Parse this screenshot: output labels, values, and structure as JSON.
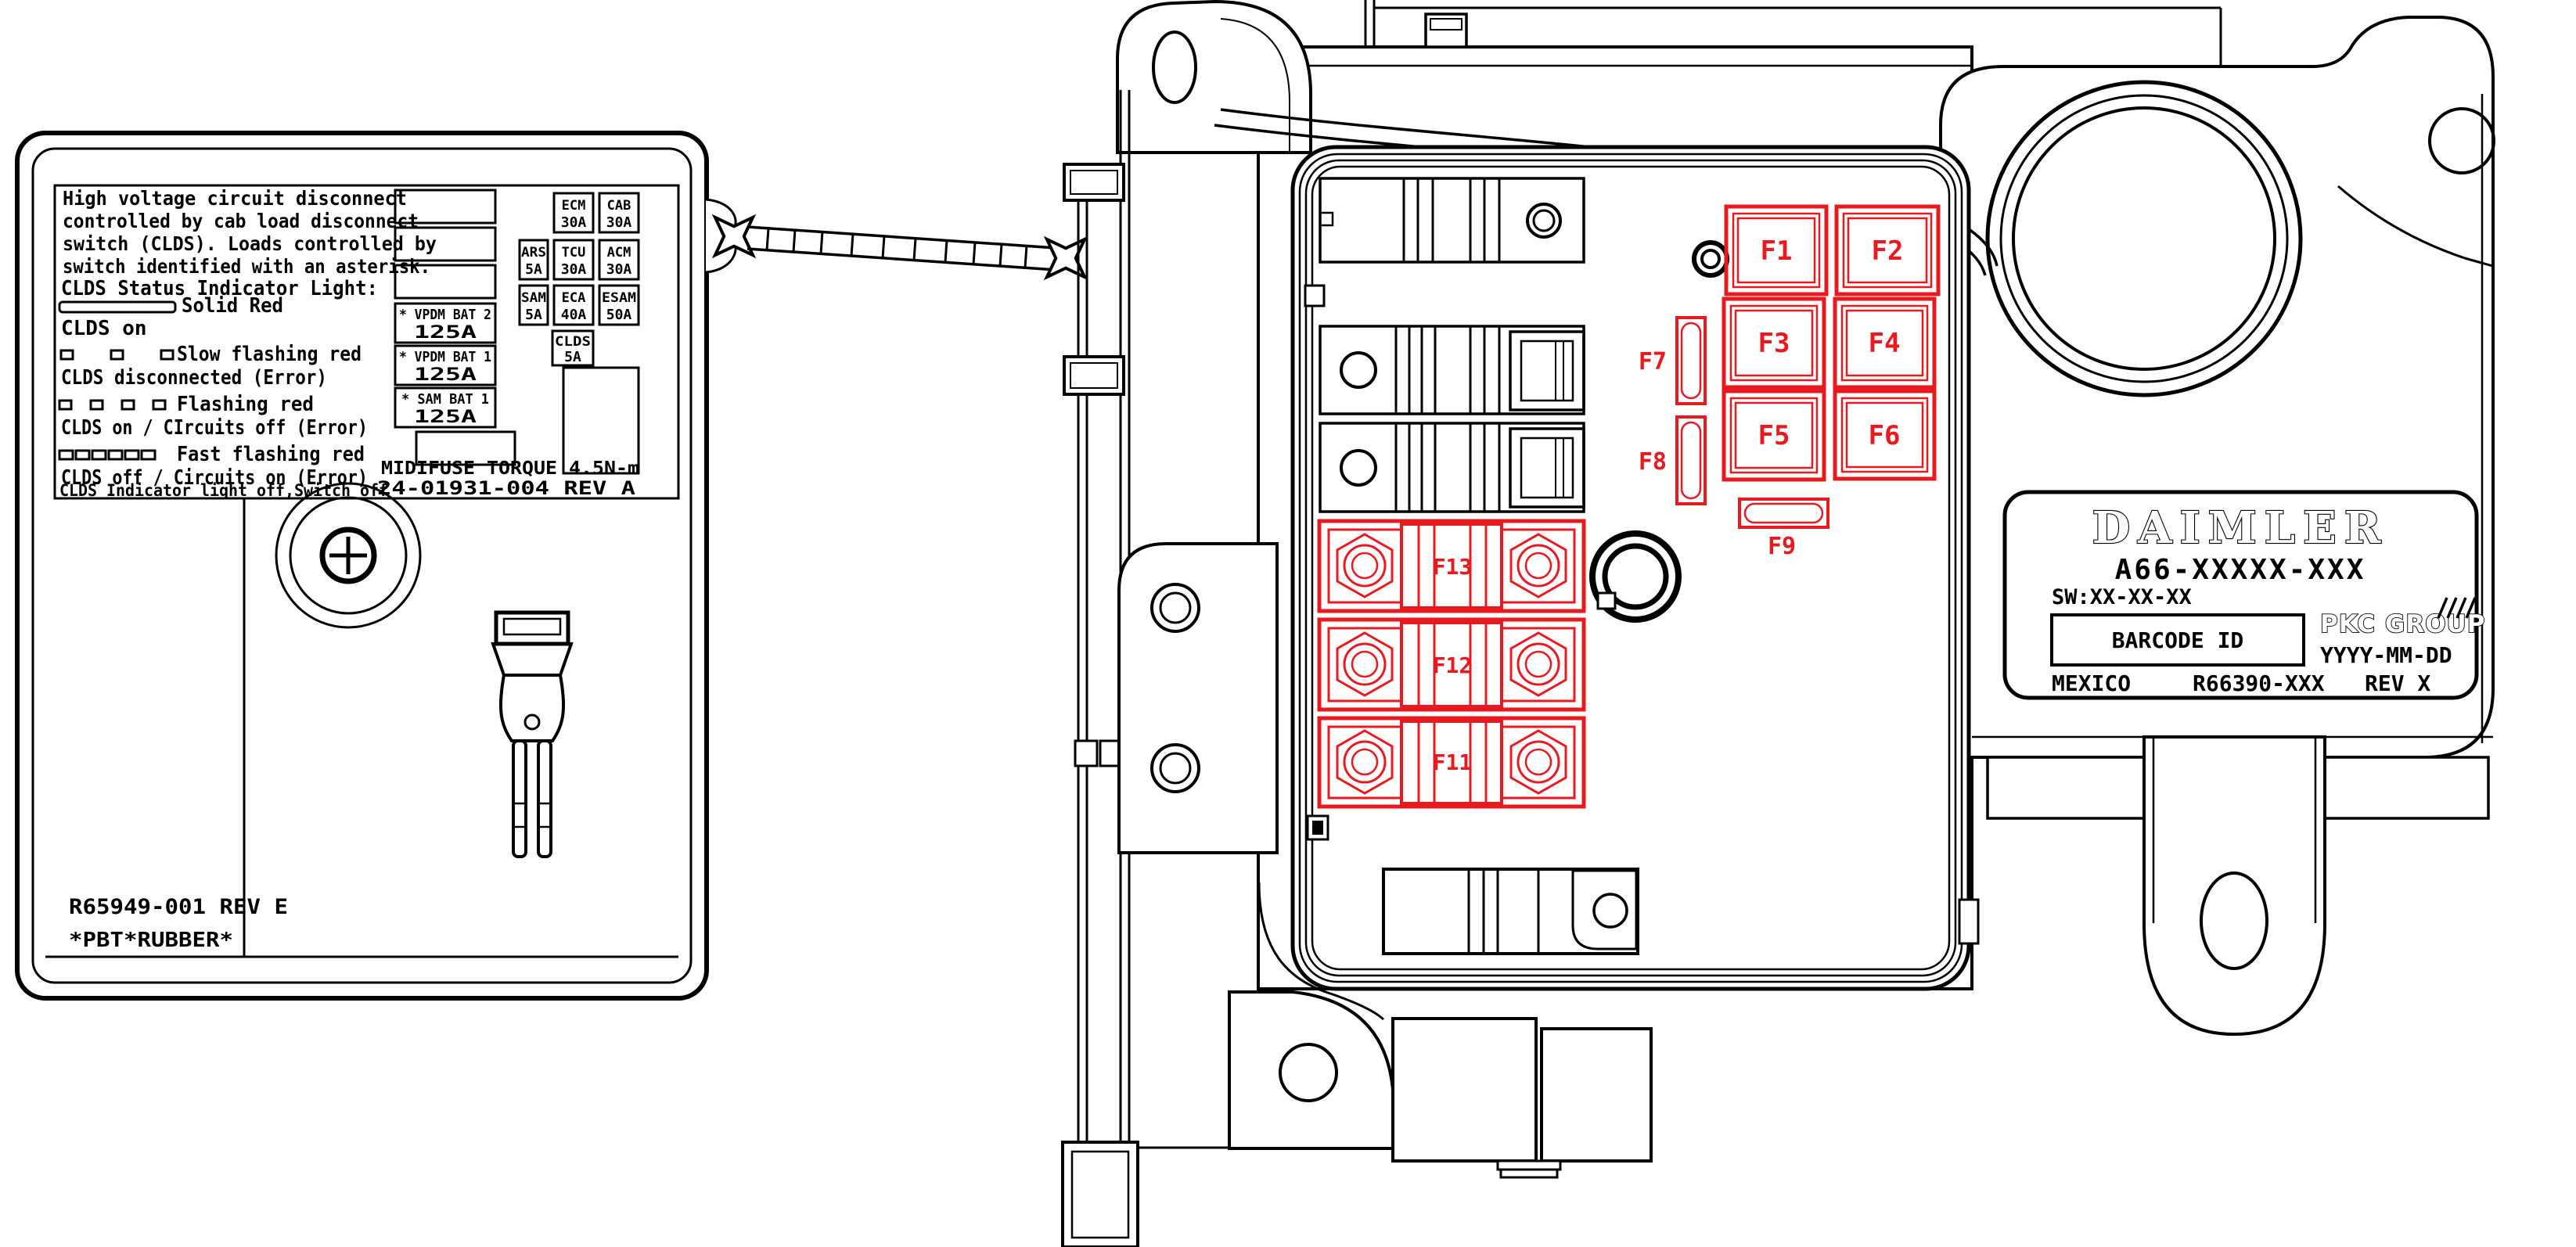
{
  "warning_label": {
    "description_lines": [
      "High voltage circuit disconnect",
      "controlled by cab load disconnect",
      "switch (CLDS).  Loads controlled by",
      "switch identified with an asterisk."
    ],
    "status_title": "CLDS Status Indicator Light:",
    "states": [
      {
        "pattern": "solid",
        "label": "Solid Red",
        "meaning": "CLDS on"
      },
      {
        "pattern": "slow-flash",
        "label": "Slow flashing red",
        "meaning": "CLDS disconnected (Error)"
      },
      {
        "pattern": "flash",
        "label": "Flashing red",
        "meaning": "CLDS on / CIrcuits off (Error)"
      },
      {
        "pattern": "fast-flash",
        "label": "Fast flashing red",
        "meaning": "CLDS off / Circuits on (Error)"
      }
    ],
    "off_note": "CLDS Indicator light off,Switch off",
    "midi_fuses": [
      {
        "name": "* VPDM BAT 2",
        "rating": "125A"
      },
      {
        "name": "* VPDM BAT 1",
        "rating": "125A"
      },
      {
        "name": "* SAM BAT 1",
        "rating": "125A"
      }
    ],
    "mini_fuses": [
      {
        "name": "ECM",
        "rating": "30A"
      },
      {
        "name": "CAB",
        "rating": "30A"
      },
      {
        "name": "ARS",
        "rating": "5A"
      },
      {
        "name": "TCU",
        "rating": "30A"
      },
      {
        "name": "ACM",
        "rating": "30A"
      },
      {
        "name": "SAM",
        "rating": "5A"
      },
      {
        "name": "ECA",
        "rating": "40A"
      },
      {
        "name": "ESAM",
        "rating": "50A"
      },
      {
        "name": "CLDS",
        "rating": "5A"
      }
    ],
    "torque_note": "MIDIFUSE TORQUE 4.5N-m",
    "doc_number": "24-01931-004 REV A",
    "part_number": "R65949-001 REV E",
    "material": "*PBT*RUBBER*"
  },
  "pdm": {
    "highlight_color": "#e8191f",
    "mini_fuse_positions": [
      "F1",
      "F2",
      "F3",
      "F4",
      "F5",
      "F6"
    ],
    "cartridge_fuse_positions": [
      "F7",
      "F8",
      "F9"
    ],
    "midi_fuse_positions": [
      "F13",
      "F12",
      "F11"
    ]
  },
  "product_label": {
    "brand": "DAIMLER",
    "part_number": "A66-XXXXX-XXX",
    "software": "SW:XX-XX-XX",
    "barcode_placeholder": "BARCODE ID",
    "manufacturer": "PKC GROUP",
    "date_format": "YYYY-MM-DD",
    "country": "MEXICO",
    "ref_number": "R66390-XXX",
    "revision": "REV X"
  }
}
